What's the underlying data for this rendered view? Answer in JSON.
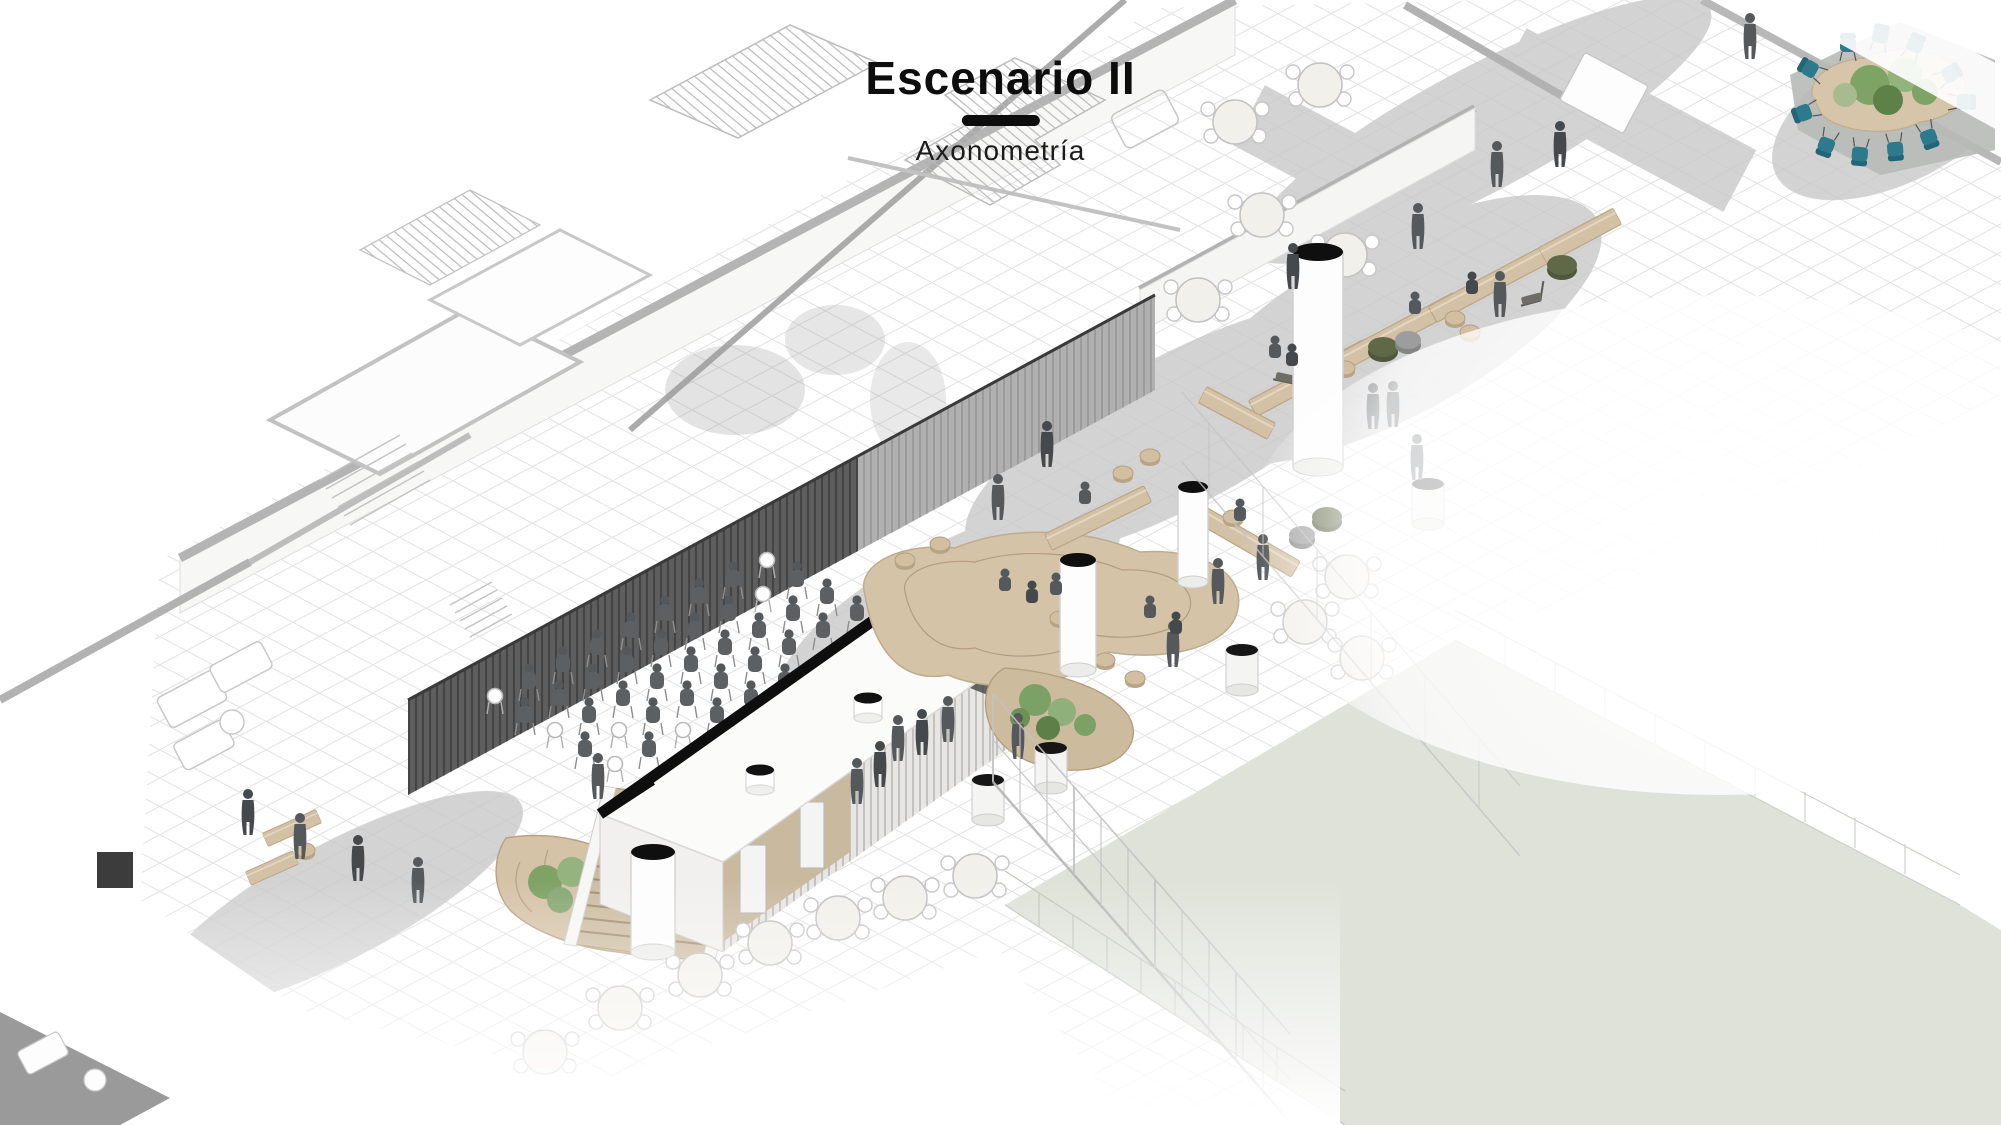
{
  "header": {
    "title": "Escenario II",
    "subtitle": "Axonometría"
  },
  "palette": {
    "background": "#ffffff",
    "ink": "#0d0d0d",
    "line_light": "#c9c9c9",
    "wall_gray": "#b2b2b2",
    "slat_dark": "#5e5e5e",
    "slat_light": "#ababab",
    "tile_line": "#e2e2e2",
    "path_gray": "#c9c9c9",
    "tan": "#d5c3a8",
    "tan_dark": "#b8a387",
    "stair_tread": "#cdbca1",
    "lawn_green": "#dfe2d9",
    "plant_green": "#7ca166",
    "olive": "#5f6847",
    "pouf_gray": "#9a9a9a",
    "teal": "#2c7a8c",
    "person_gray": "#55595c",
    "roof_white": "#fbfbfa"
  }
}
